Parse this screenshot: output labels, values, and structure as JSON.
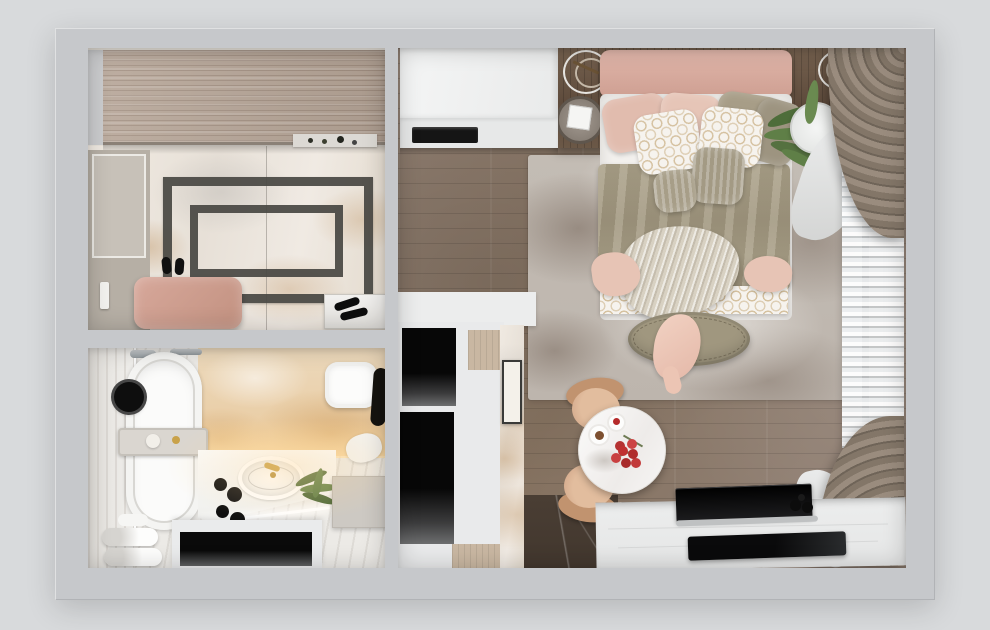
{
  "scene": {
    "kind": "apartment-floor-plan-3d-render",
    "view": "top-down",
    "contains_text": false
  },
  "palette": {
    "outer": "#d8dadc",
    "wall": "#c6c8cb",
    "woodWardrobe": "#b5a496",
    "marbleVein": "#c08a4f",
    "frameDark": "#514f4b",
    "doorGreige": "#b6afa5",
    "benchPink": "#cfa195",
    "woodFloor": "#8e7d70",
    "rug": "#c3bcb4",
    "headboardPink": "#d9aea2",
    "pillowPink": "#e3c0b2",
    "duvetOlive": "#a69c85",
    "patternGold": "#ba9860",
    "throwKnit": "#d8d1c2",
    "ottomanOlive": "#a0977f",
    "consoleWood": "#6b584a",
    "drapeTaupe": "#837668",
    "sheerWhite": "#eef1f3",
    "tableWhite": "#f7f6f4",
    "chairBeige": "#d9af8d",
    "deskWhite": "#e9eaea",
    "deviceBlack": "#0c0c0d",
    "nicheBlack": "#070707",
    "amberMarble": "#ecd9bc",
    "darkMarble": "#473b31",
    "plantGreen": "#5f7f47",
    "accentRed": "#c03030",
    "faucetGold": "#c9a24a",
    "glowWarm": "#ffd696"
  },
  "rooms": {
    "hallway": {
      "items": [
        "wardrobe",
        "decor-ledge",
        "marble-floor",
        "floor-inlay-frames",
        "entry-door",
        "pink-bench",
        "slippers",
        "doormat",
        "shoes"
      ]
    },
    "bathroom": {
      "items": [
        "shower-area",
        "bathtub",
        "shower-head",
        "bath-caddy",
        "chrome-fixtures",
        "amber-marble-wall",
        "toilet",
        "hanging-robe",
        "vanity-counter",
        "led-strip",
        "sink",
        "gold-faucet",
        "cosmetics",
        "palm-plant",
        "side-cabinet",
        "towel-rolls",
        "open-shelf"
      ]
    },
    "living_bedroom": {
      "items": [
        "kitchen-cabinets",
        "appliance-slot",
        "console-shelf",
        "decor-rings",
        "mirror-tray",
        "bed",
        "headboard",
        "pillows",
        "patterned-pillows",
        "duvet",
        "patterned-runner",
        "knit-throw",
        "foot-blankets",
        "ottoman",
        "draped-shirt",
        "area-rug",
        "potted-plant",
        "sheer-curtain",
        "drape-top",
        "drape-bottom",
        "dining-table",
        "coffee-plates",
        "berry-centerpiece",
        "chairs",
        "storage-niches",
        "wood-trim",
        "marble-strip",
        "leaning-art",
        "dark-marble-floor",
        "desk",
        "monitor",
        "tablet",
        "camera"
      ]
    }
  }
}
